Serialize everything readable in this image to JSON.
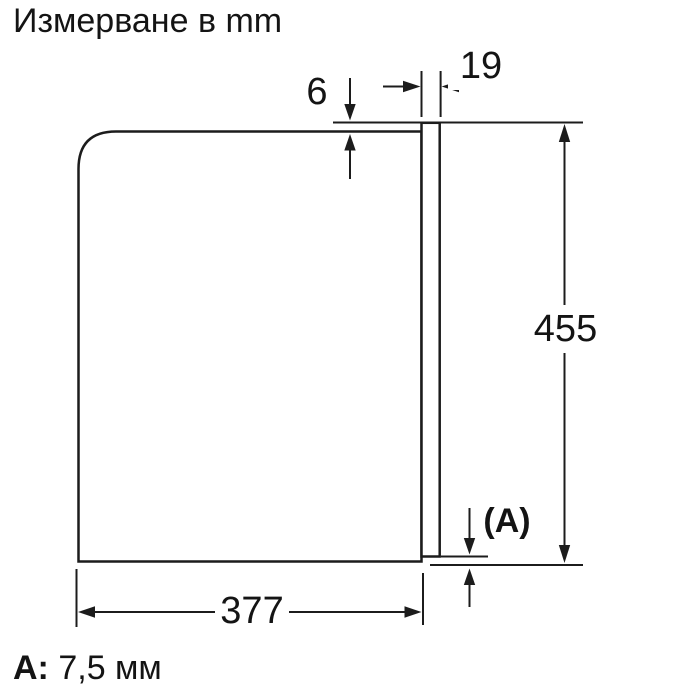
{
  "title": "Измерване в mm",
  "dimensions": {
    "top_clearance_mm": "6",
    "panel_depth_mm": "19",
    "height_mm": "455",
    "width_mm": "377",
    "bottom_gap_label": "(A)"
  },
  "legend": {
    "key": "A:",
    "value": "7,5 мм"
  },
  "colors": {
    "line": "#1c1c1c",
    "text": "#141414",
    "background": "#ffffff"
  }
}
